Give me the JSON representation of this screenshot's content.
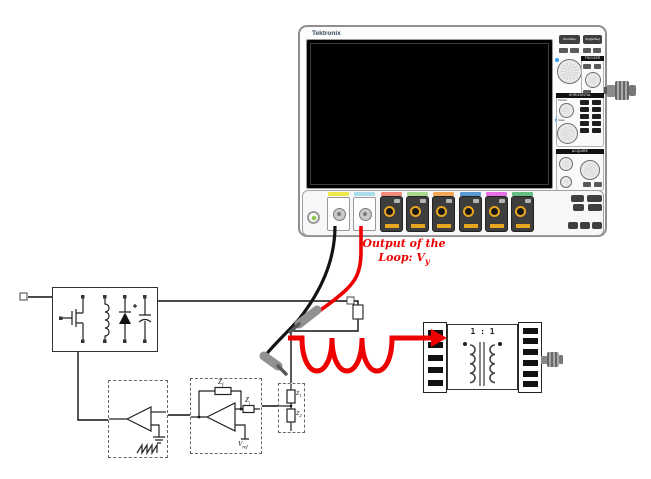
{
  "scope": {
    "brand": "Tektronix",
    "panel": {
      "run_stop": "Run/Stop",
      "single_seq": "Single/Seq",
      "trigger_header": "TRIGGER",
      "horizontal_header": "HORIZONTAL",
      "acquire_header": "ACQUIRE",
      "position_label": "Position",
      "scale_label": "Scale"
    },
    "channel_colors": [
      "#f0e84b",
      "#abdcec",
      "#f28b77",
      "#a8d98f",
      "#f2a857",
      "#5b9bd5",
      "#e570e5",
      "#66bd82"
    ],
    "accent_colors": {
      "tekvpi_yellow": "#e8a520",
      "power_led_green": "#8bc34a",
      "knob_led_blue": "#2e9df2"
    }
  },
  "annotation": {
    "color": "#ee0000",
    "line1": "Output of the",
    "line2_base": "Loop: V",
    "line2_sub": "y"
  },
  "injection": {
    "transformer_ratio": "1 : 1"
  },
  "error_amp": {
    "zf_base": "Z",
    "zf_sub": "f",
    "zi_base": "Z",
    "zi_sub": "i",
    "vref_base": "V",
    "vref_sub": "ref"
  },
  "divider": {
    "z1_base": "Z",
    "z1_sub": "1",
    "z2_base": "Z",
    "z2_sub": "2"
  }
}
